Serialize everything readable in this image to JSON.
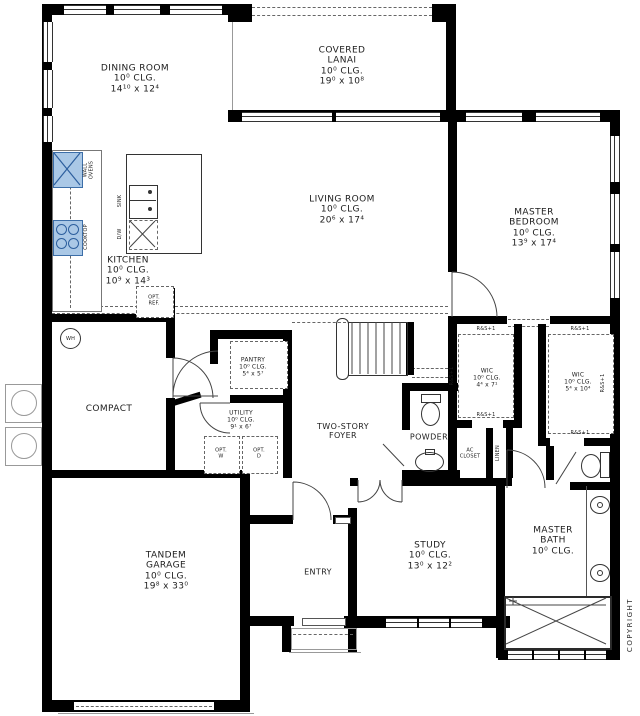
{
  "rooms": {
    "dining": [
      "DINING ROOM",
      "10⁰ CLG.",
      "14¹⁰ x 12⁴"
    ],
    "lanai": [
      "COVERED",
      "LANAI",
      "10⁰ CLG.",
      "19⁰ x 10⁸"
    ],
    "living": [
      "LIVING ROOM",
      "10⁰ CLG.",
      "20⁶ x 17⁴"
    ],
    "master_bedroom": [
      "MASTER",
      "BEDROOM",
      "10⁰ CLG.",
      "13⁹ x 17⁴"
    ],
    "kitchen": [
      "KITCHEN",
      "10⁰ CLG.",
      "10⁹ x 14³"
    ],
    "pantry": [
      "PANTRY",
      "10⁰ CLG.",
      "5⁴ x 5⁷"
    ],
    "utility": [
      "UTILITY",
      "10⁰ CLG.",
      "9¹ x 6⁷"
    ],
    "foyer": [
      "TWO-STORY",
      "FOYER"
    ],
    "powder": [
      "POWDER"
    ],
    "compact": [
      "COMPACT"
    ],
    "garage": [
      "TANDEM",
      "GARAGE",
      "10⁰ CLG.",
      "19⁸ x 33⁰"
    ],
    "entry": [
      "ENTRY"
    ],
    "study": [
      "STUDY",
      "10⁰ CLG.",
      "13⁰ x 12²"
    ],
    "wic_left": [
      "WIC",
      "10⁰ CLG.",
      "4⁴ x 7¹"
    ],
    "wic_right": [
      "WIC",
      "10⁰ CLG.",
      "5⁴ x 10⁴"
    ],
    "master_bath": [
      "MASTER",
      "BATH",
      "10⁰ CLG."
    ],
    "ac_closet": [
      "AC",
      "CLOSET"
    ],
    "linen": "LINEN"
  },
  "fixtures": {
    "wall_ovens": [
      "WALL",
      "OVENS"
    ],
    "sink": "SINK",
    "dishwasher": "D/W",
    "cooktop": "COOKTOP",
    "opt_ref": [
      "OPT.",
      "REF."
    ],
    "water_heater": "WH",
    "opt_washer": [
      "OPT.",
      "W"
    ],
    "opt_dryer": [
      "OPT.",
      "D"
    ],
    "rod_and_shelf": "R&S+1"
  },
  "annotations": {
    "copyright": "COPYRIGHT"
  },
  "colors": {
    "wall": "#000000",
    "appliance_fill": "#aac8e6",
    "appliance_line": "#3c6ea8",
    "linework": "#444444"
  }
}
